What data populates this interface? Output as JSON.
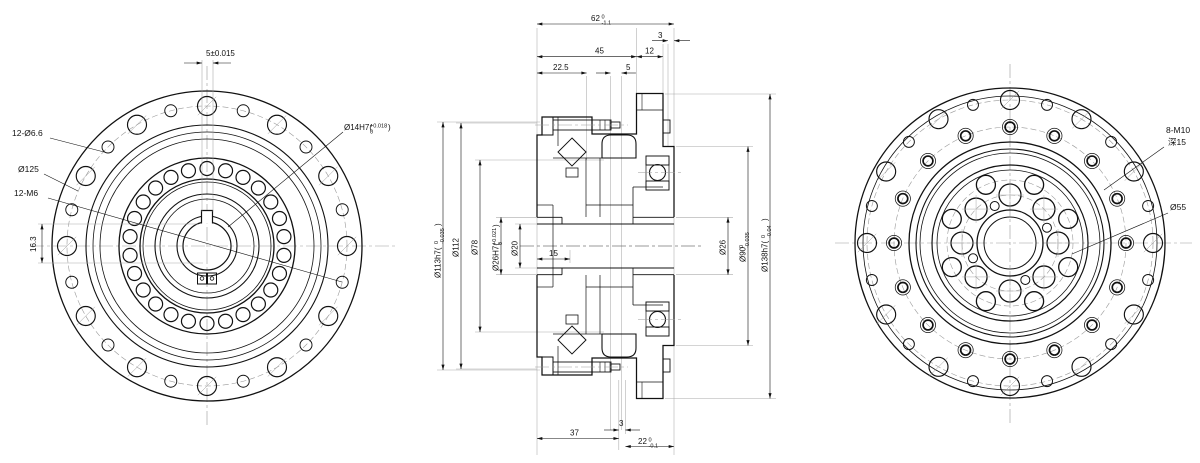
{
  "drawing_title": "Harmonic gear reducer - three view engineering drawing",
  "front_view": {
    "dim_keyway_width": "5±0.015",
    "label_holes_outer": "12-Ø6.6",
    "label_bolt_circle": "Ø125",
    "label_holes_inner": "12-M6",
    "dim_keyway_height": "16.3",
    "bore": {
      "pre": "Ø14H7(",
      "up": "+0.018",
      "dn": "0",
      "post": ")"
    }
  },
  "section_view": {
    "top": {
      "overall": {
        "pre": "62",
        "up": "0",
        "dn": "-1.1",
        "post": ""
      },
      "d3": "3",
      "d45": "45",
      "d12": "12",
      "d225": "22.5",
      "d5": "5"
    },
    "bottom": {
      "d37": "37",
      "d3": "3",
      "d22": {
        "pre": "22",
        "up": "0",
        "dn": "-0.1",
        "post": ""
      }
    },
    "left": {
      "d113": {
        "pre": "Ø113h7(",
        "up": "0",
        "dn": "-0.035",
        "post": ")"
      },
      "d112": "Ø112",
      "d78": "Ø78",
      "d26": {
        "pre": "Ø26H7(",
        "up": "+0.021",
        "dn": "0",
        "post": ")"
      },
      "d20": "Ø20",
      "d15": "15"
    },
    "right": {
      "d26": "Ø26",
      "d90": {
        "pre": "Ø90",
        "up": "0",
        "dn": "-0.035",
        "post": ""
      },
      "d138": {
        "pre": "Ø138h7(",
        "up": "0",
        "dn": "-0.04",
        "post": ")"
      }
    }
  },
  "back_view": {
    "label_tapped": "8-M10",
    "label_depth": "深15",
    "label_d55": "Ø55"
  }
}
